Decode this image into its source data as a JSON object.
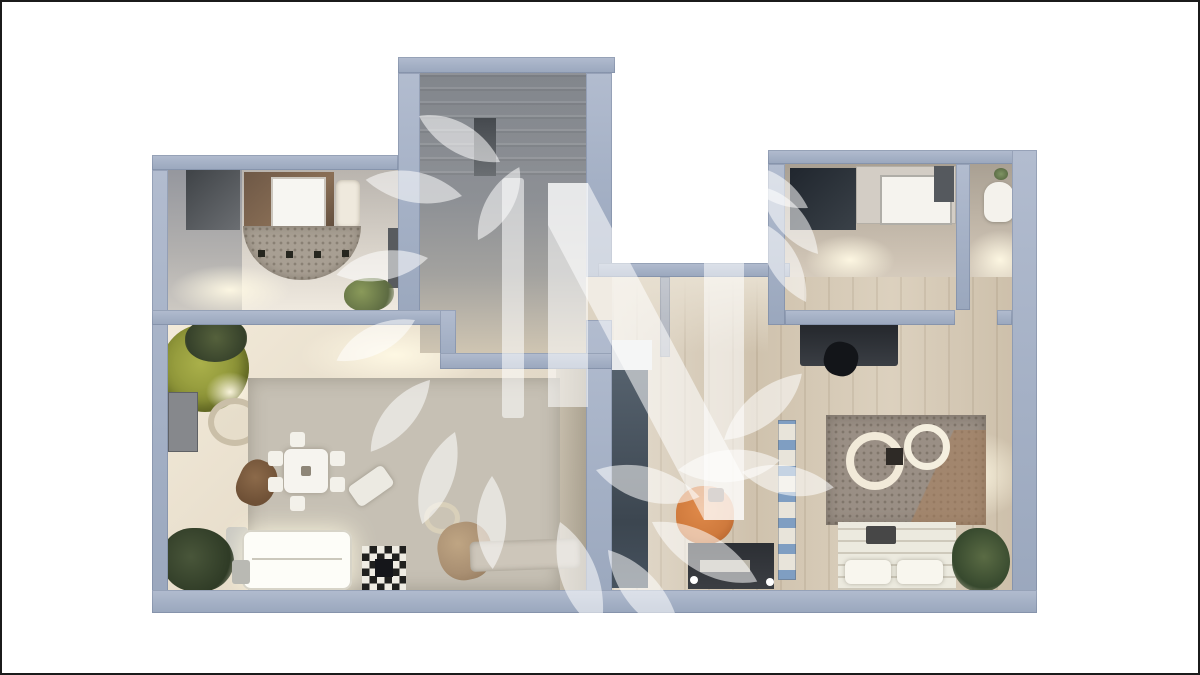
{
  "page": {
    "background": "#ffffff",
    "frame_color": "#1b1b1b"
  },
  "watermark": {
    "text": "N",
    "leading_bar": true,
    "motif": "laurel-branch-leaves",
    "color": "#ffffff",
    "opacity": 0.55
  },
  "palette": {
    "wall": "#a4b0c5",
    "wall_edge": "#52627e",
    "stair_floor": "#8d9095",
    "warm_floor": "#e6dccb",
    "wood_floor": "#d9cdb9",
    "rug_field": "#c6c0b4",
    "rug_dot": "#2f2f2b",
    "accent_orange": "#cf7a3d",
    "accent_olive": "#8d9438",
    "sofa_white": "#fdfdf8",
    "dark_furniture": "#33363b"
  },
  "floorplan": {
    "view": "top-down 3D apartment render",
    "rooms": [
      {
        "id": "stair-hall",
        "furniture": [
          "staircase",
          "dark-doorway"
        ]
      },
      {
        "id": "room-upper-left",
        "furniture": [
          "shower-closet",
          "dark-wardrobe",
          "vanity-with-sink",
          "stool",
          "semicircular-rug",
          "radiator",
          "plant"
        ]
      },
      {
        "id": "room-upper-right",
        "furniture": [
          "dark-mat",
          "white-desk",
          "counter",
          "partition-wall",
          "toilet",
          "small-plant"
        ]
      },
      {
        "id": "living-room",
        "furniture": [
          "potted-tree",
          "floor-lamp",
          "wall-cabinet",
          "rattan-chair",
          "dotted-rug",
          "dining-table-with-chairs",
          "lounge-chair",
          "bench",
          "ring-table",
          "pouf",
          "console-bench",
          "sofa",
          "checkered-ottoman",
          "floor-plants",
          "side-table"
        ]
      },
      {
        "id": "bedroom",
        "furniture": [
          "wardrobe",
          "desk-with-chair",
          "circle-pattern-duvet-rug",
          "bed-with-pillows",
          "tv-cabinet",
          "orange-armchair",
          "ladder-shelf",
          "plant"
        ]
      }
    ]
  }
}
